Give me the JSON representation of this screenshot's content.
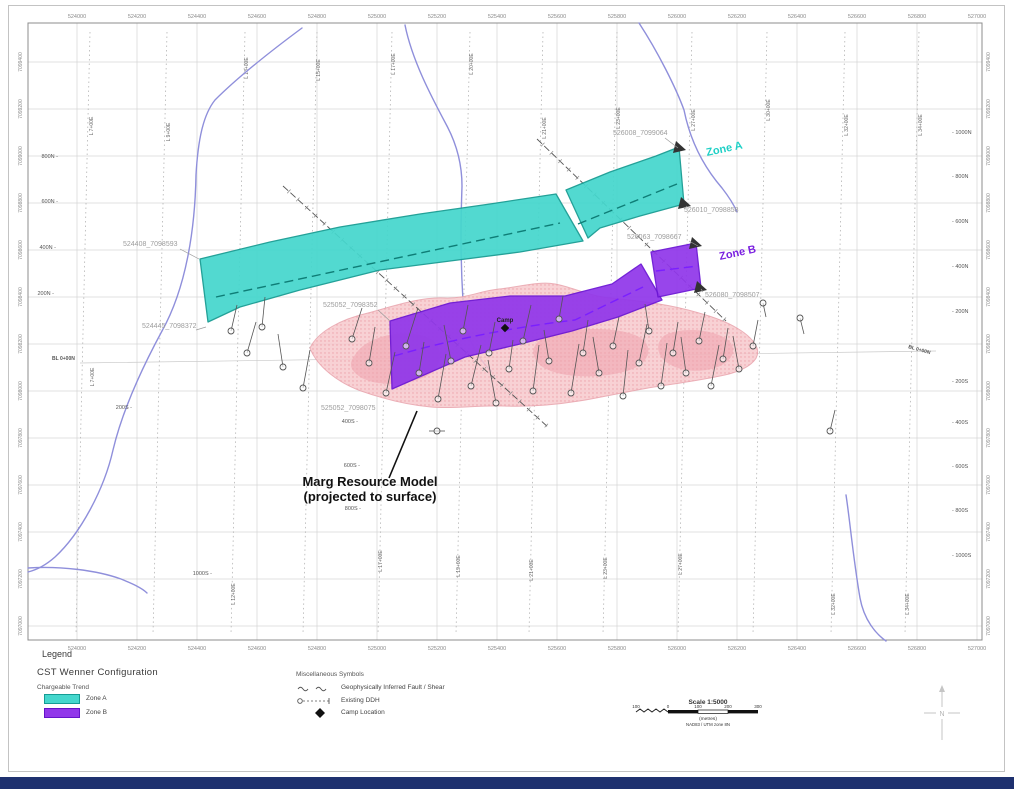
{
  "legend": {
    "title": "Legend",
    "cst_title": "CST Wenner Configuration",
    "chargeable_trend": "Chargeable Trend",
    "zone_a_label": "Zone A",
    "zone_b_label": "Zone B",
    "zone_a_color": "#45d7cd",
    "zone_a_border": "#159c94",
    "zone_b_color": "#9137ea",
    "zone_b_border": "#6414c9",
    "misc_title": "Miscellaneous Symbols",
    "fault_label": "Geophysically Inferred Fault / Shear",
    "ddh_label": "Existing DDH",
    "camp_label": "Camp Location",
    "scale_title": "Scale 1:5000",
    "scale_ticks": [
      "100",
      "0",
      "100",
      "200",
      "300"
    ],
    "scale_units": "(metres)",
    "scale_datum": "NAD83 / UTM zone 8N",
    "north_label": "N"
  },
  "map": {
    "frame": {
      "x": 28,
      "y": 23,
      "w": 954,
      "h": 617,
      "stroke": "#8c8c8c"
    },
    "grid_color": "#d6d6d6",
    "easting": {
      "x0": 77,
      "step": 60,
      "labels": [
        "524000",
        "524200",
        "524400",
        "524600",
        "524800",
        "525000",
        "525200",
        "525400",
        "525600",
        "525800",
        "526000",
        "526200",
        "526400",
        "526600",
        "526800",
        "527000"
      ]
    },
    "northing": {
      "y0": 62,
      "step": 47,
      "labels": [
        "7099400",
        "7099200",
        "7099000",
        "7098800",
        "7098600",
        "7098400",
        "7098200",
        "7098000",
        "7097800",
        "7097600",
        "7097400",
        "7097200",
        "7097000"
      ]
    },
    "survey_lines": [
      {
        "x": 90,
        "top": "L 7+00E",
        "ty": 126,
        "mid": "L 7+00E",
        "my": 377
      },
      {
        "x": 167,
        "top": "L 9+00E",
        "ty": 132
      },
      {
        "x": 245,
        "top": "L 13+00E",
        "ty": 68,
        "bottom": "L 12+00E",
        "by": 594
      },
      {
        "x": 317,
        "top": "L 15+00E",
        "ty": 70
      },
      {
        "x": 392,
        "top": "L 17+00E",
        "ty": 64,
        "bottom": "L 17+00E",
        "by": 561
      },
      {
        "x": 470,
        "top": "L 20+00E",
        "ty": 64,
        "bottom": "L 19+00E",
        "by": 566
      },
      {
        "x": 543,
        "top": "L 21+00E",
        "ty": 128,
        "bottom": "L 21+00E",
        "by": 570
      },
      {
        "x": 617,
        "top": "L 23+00E",
        "ty": 118,
        "bottom": "L 23+00E",
        "by": 568
      },
      {
        "x": 692,
        "top": "L 27+00E",
        "ty": 120,
        "bottom": "L 27+00E",
        "by": 564
      },
      {
        "x": 767,
        "top": "L 30+00E",
        "ty": 110
      },
      {
        "x": 845,
        "top": "L 32+00E",
        "ty": 125,
        "bottom": "L 32+00E",
        "by": 604
      },
      {
        "x": 919,
        "top": "L 34+00E",
        "ty": 125,
        "bottom": "L 34+00E",
        "by": 604
      }
    ],
    "stations_left": [
      {
        "t": "800N -",
        "x": 58,
        "y": 158
      },
      {
        "t": "600N -",
        "x": 58,
        "y": 203
      },
      {
        "t": "400N -",
        "x": 56,
        "y": 249
      },
      {
        "t": "200N -",
        "x": 54,
        "y": 295
      }
    ],
    "stations_right": [
      {
        "t": "- 1000N",
        "y": 134
      },
      {
        "t": "- 800N",
        "y": 178
      },
      {
        "t": "- 600N",
        "y": 223
      },
      {
        "t": "- 400N",
        "y": 268
      },
      {
        "t": "- 200N",
        "y": 313
      },
      {
        "t": "- 200S",
        "y": 383
      },
      {
        "t": "- 400S",
        "y": 424
      },
      {
        "t": "- 600S",
        "y": 468
      },
      {
        "t": "- 800S",
        "y": 512
      },
      {
        "t": "- 1000S",
        "y": 557
      }
    ],
    "stations_mid": [
      {
        "t": "200S -",
        "x": 132,
        "y": 409
      },
      {
        "t": "400S -",
        "x": 358,
        "y": 423
      },
      {
        "t": "600S -",
        "x": 360,
        "y": 467
      },
      {
        "t": "800S -",
        "x": 361,
        "y": 510
      },
      {
        "t": "1000S -",
        "x": 212,
        "y": 575
      }
    ],
    "baseline": {
      "x1": 80,
      "y1": 363,
      "x2": 936,
      "y2": 351
    },
    "baseline_labels": [
      {
        "t": "BL 0+00N",
        "x": 52,
        "y": 360,
        "rot": 0
      },
      {
        "t": "BL 0+00N",
        "x": 908,
        "y": 348,
        "rot": 16
      }
    ],
    "creeks": {
      "color": "#8f8fdb",
      "paths": [
        "M302,28 C275,48 240,75 215,100 C203,115 198,140 196,175 C195,230 186,288 162,331 C142,368 122,412 113,450 C104,490 80,534 55,557 C46,565 36,570 28,572",
        "M28,568 C60,566 96,570 121,579 C133,584 142,588 147,593",
        "M405,25 C412,60 431,96 447,126 C457,145 462,165 462,186 C461,216 460,252 463,301 C464,331 473,353 491,371",
        "M639,23 C658,52 676,88 684,110 C690,140 703,166 722,188 C729,197 734,205 737,212",
        "M846,495 C850,521 853,557 860,598 C864,620 876,634 886,641"
      ]
    },
    "resource_model": {
      "fill": "#f7c9cd",
      "dot": "#ea9aa4",
      "stroke": "#e8a2ab",
      "outline": "M310,348 C318,331 342,319 368,313 C394,306 420,297 444,298 C466,299 479,291 499,289 C519,287 539,281 555,284 C572,287 589,296 610,298 C640,301 669,304 699,313 C728,321 751,333 757,348 C761,360 747,369 729,374 C704,380 679,383 654,387 C629,391 604,397 579,401 C554,405 529,407 504,406 C479,405 454,409 431,407 C409,405 384,399 361,391 C339,383 317,367 310,348 Z",
      "patches": [
        "M355,355 C365,338 395,330 420,335 C440,339 445,355 435,370 C420,385 380,388 362,378 C350,371 348,364 355,355 Z",
        "M540,340 C560,328 610,325 635,335 C655,343 652,362 630,370 C600,380 555,378 540,365 C532,357 530,348 540,340 Z",
        "M665,335 C685,326 715,330 728,340 C738,349 733,362 715,368 C695,374 672,370 662,358 C656,350 657,341 665,335 Z"
      ]
    },
    "faults": {
      "color": "#555555",
      "lines": [
        [
          283,
          186,
          549,
          428
        ],
        [
          537,
          139,
          726,
          321
        ]
      ]
    },
    "zone_a": {
      "fill": "#45d7cd",
      "stroke": "#149a91",
      "center": "#0e7d76",
      "left": [
        [
          200,
          259
        ],
        [
          270,
          242
        ],
        [
          340,
          227
        ],
        [
          420,
          214
        ],
        [
          490,
          204
        ],
        [
          556,
          194
        ],
        [
          583,
          241
        ],
        [
          520,
          252
        ],
        [
          450,
          261
        ],
        [
          380,
          270
        ],
        [
          300,
          290
        ],
        [
          240,
          307
        ],
        [
          208,
          322
        ]
      ],
      "right": [
        [
          566,
          190
        ],
        [
          610,
          172
        ],
        [
          656,
          156
        ],
        [
          679,
          147
        ],
        [
          684,
          204
        ],
        [
          640,
          216
        ],
        [
          600,
          228
        ],
        [
          588,
          238
        ]
      ],
      "centerlines": [
        "M216,297 L560,223",
        "M578,224 L677,184"
      ],
      "arrows": [
        "676,141 686,150 673,153",
        "681,197 691,206 678,209"
      ]
    },
    "zone_b": {
      "fill": "#9137ea",
      "stroke": "#6a14d4",
      "center": "#7a1fff",
      "left": [
        [
          390,
          321
        ],
        [
          450,
          303
        ],
        [
          510,
          296
        ],
        [
          565,
          296
        ],
        [
          612,
          284
        ],
        [
          641,
          264
        ],
        [
          662,
          300
        ],
        [
          618,
          317
        ],
        [
          572,
          331
        ],
        [
          520,
          344
        ],
        [
          465,
          357
        ],
        [
          392,
          389
        ]
      ],
      "right": [
        [
          651,
          252
        ],
        [
          696,
          243
        ],
        [
          701,
          288
        ],
        [
          658,
          297
        ]
      ],
      "centerlines": [
        "M394,356 C470,334 540,324 575,320 L643,287",
        "M656,271 L698,266"
      ],
      "arrows": [
        "692,237 702,246 689,249",
        "697,281 707,290 694,293"
      ]
    },
    "drill_holes": {
      "color": "#555555",
      "list": [
        [
          231,
          331,
          6,
          -26
        ],
        [
          262,
          327,
          3,
          -30
        ],
        [
          247,
          353,
          9,
          -31
        ],
        [
          283,
          367,
          -5,
          -33
        ],
        [
          303,
          388,
          7,
          -38
        ],
        [
          352,
          339,
          10,
          -31
        ],
        [
          369,
          363,
          6,
          -36
        ],
        [
          386,
          393,
          9,
          -41
        ],
        [
          406,
          346,
          12,
          -38
        ],
        [
          419,
          373,
          5,
          -31
        ],
        [
          438,
          399,
          8,
          -45
        ],
        [
          451,
          361,
          -7,
          -36
        ],
        [
          463,
          331,
          5,
          -26
        ],
        [
          471,
          386,
          10,
          -41
        ],
        [
          489,
          353,
          6,
          -31
        ],
        [
          496,
          403,
          -8,
          -43
        ],
        [
          509,
          369,
          4,
          -29
        ],
        [
          523,
          341,
          8,
          -36
        ],
        [
          533,
          391,
          6,
          -46
        ],
        [
          549,
          361,
          -5,
          -31
        ],
        [
          559,
          319,
          4,
          -23
        ],
        [
          571,
          393,
          8,
          -49
        ],
        [
          583,
          353,
          5,
          -33
        ],
        [
          599,
          373,
          -6,
          -36
        ],
        [
          613,
          346,
          6,
          -29
        ],
        [
          623,
          396,
          5,
          -46
        ],
        [
          639,
          363,
          8,
          -39
        ],
        [
          649,
          331,
          -4,
          -27
        ],
        [
          661,
          386,
          6,
          -43
        ],
        [
          673,
          353,
          5,
          -31
        ],
        [
          686,
          373,
          -5,
          -36
        ],
        [
          699,
          341,
          6,
          -29
        ],
        [
          711,
          386,
          8,
          -41
        ],
        [
          723,
          359,
          5,
          -31
        ],
        [
          739,
          369,
          -6,
          -33
        ],
        [
          753,
          346,
          5,
          -26
        ],
        [
          763,
          303,
          3,
          14
        ],
        [
          800,
          318,
          4,
          16
        ],
        [
          830,
          431,
          5,
          -21
        ],
        [
          437,
          431,
          8,
          0,
          1
        ]
      ]
    },
    "camp": {
      "x": 505,
      "y": 328,
      "label": "Camp"
    },
    "annotations": {
      "color": "#9c9c9c",
      "items": [
        {
          "t": "524408_7098593",
          "x": 123,
          "y": 246,
          "leader": [
            180,
            249,
            199,
            259
          ]
        },
        {
          "t": "524445_7098372",
          "x": 142,
          "y": 328,
          "leader": [
            196,
            330,
            206,
            327
          ]
        },
        {
          "t": "525052_7098352",
          "x": 323,
          "y": 307,
          "leader": [
            378,
            310,
            390,
            321
          ]
        },
        {
          "t": "525052_7098075",
          "x": 321,
          "y": 410
        },
        {
          "t": "526008_7099064",
          "x": 613,
          "y": 135,
          "leader": [
            665,
            138,
            678,
            148
          ]
        },
        {
          "t": "526010_7098858",
          "x": 684,
          "y": 212,
          "leader": [
            687,
            206,
            684,
            209
          ]
        },
        {
          "t": "526063_7098667",
          "x": 627,
          "y": 239,
          "leader": [
            689,
            241,
            698,
            246
          ]
        },
        {
          "t": "526080_7098507",
          "x": 705,
          "y": 297,
          "leader": [
            703,
            292,
            701,
            289
          ]
        }
      ]
    },
    "zone_labels": [
      {
        "t": "Zone A",
        "x": 707,
        "y": 156,
        "c": "#1fd0c6",
        "rot": -12
      },
      {
        "t": "Zone B",
        "x": 720,
        "y": 260,
        "c": "#7a1fe0",
        "rot": -12
      }
    ],
    "marg": {
      "lines": [
        "Marg Resource Model",
        "(projected to surface)"
      ],
      "x": 370,
      "y": 486,
      "leader": [
        389,
        478,
        417,
        411
      ]
    }
  }
}
